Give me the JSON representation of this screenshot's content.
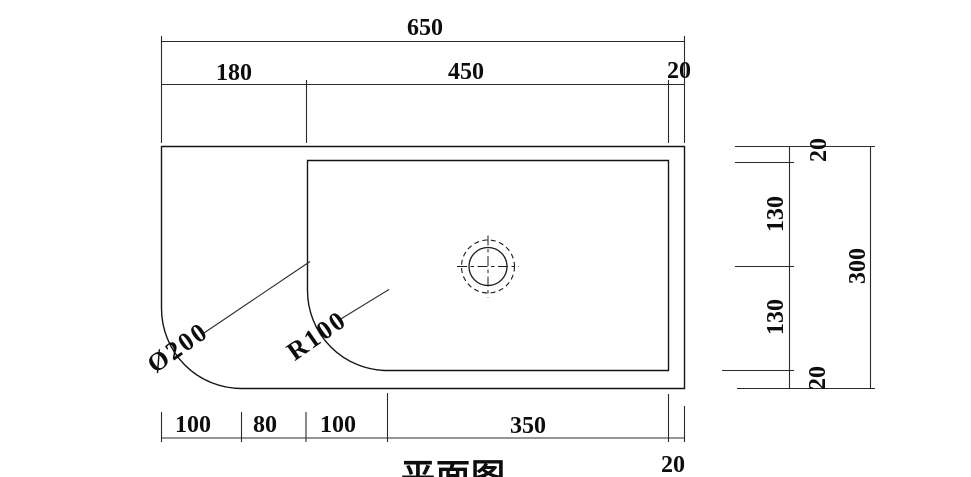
{
  "colors": {
    "line": "#1c1c1c",
    "background": "#ffffff"
  },
  "dims": {
    "top": {
      "overall": "650",
      "segments": [
        "180",
        "450",
        "20"
      ]
    },
    "bottom": {
      "segments": [
        "100",
        "80",
        "100",
        "350"
      ],
      "edge": "20"
    },
    "right": {
      "overall": "300",
      "segments": [
        "20",
        "130",
        "130",
        "20"
      ]
    },
    "corner": {
      "outer_diameter": "Ø200",
      "inner_radius": "R100"
    }
  },
  "caption": "平面图"
}
